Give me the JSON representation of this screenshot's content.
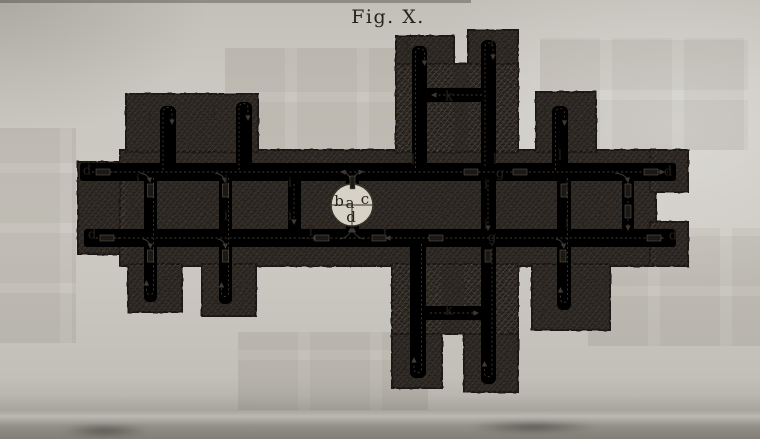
{
  "figure": {
    "title": "Fig. X."
  },
  "colors": {
    "paper": "#cac7c0",
    "mass": "#2a2521",
    "channel": "#d6d2c6",
    "ink": "#26221c",
    "flow": "#3f3a33"
  },
  "labels": [
    {
      "t": "b",
      "x": 339,
      "y": 202,
      "s": 1
    },
    {
      "t": "a",
      "x": 350,
      "y": 204,
      "s": 1
    },
    {
      "t": "c",
      "x": 365,
      "y": 200,
      "s": 1
    },
    {
      "t": "d",
      "x": 351,
      "y": 218,
      "s": 1
    },
    {
      "t": "d",
      "x": 87,
      "y": 171
    },
    {
      "t": "d",
      "x": 92,
      "y": 235
    },
    {
      "t": "d",
      "x": 668,
      "y": 172
    },
    {
      "t": "d",
      "x": 673,
      "y": 236
    },
    {
      "t": "f",
      "x": 311,
      "y": 232
    },
    {
      "t": "f",
      "x": 385,
      "y": 233
    },
    {
      "t": "g",
      "x": 500,
      "y": 174
    },
    {
      "t": "g",
      "x": 492,
      "y": 238
    },
    {
      "t": "i",
      "x": 138,
      "y": 180
    },
    {
      "t": "i",
      "x": 138,
      "y": 216
    },
    {
      "t": "i",
      "x": 226,
      "y": 181
    },
    {
      "t": "i",
      "x": 226,
      "y": 216
    },
    {
      "t": "i",
      "x": 290,
      "y": 183
    },
    {
      "t": "i",
      "x": 290,
      "y": 216
    },
    {
      "t": "i",
      "x": 486,
      "y": 185
    },
    {
      "t": "i",
      "x": 486,
      "y": 225
    },
    {
      "t": "i",
      "x": 567,
      "y": 186
    },
    {
      "t": "i",
      "x": 567,
      "y": 224
    },
    {
      "t": "k",
      "x": 449,
      "y": 97
    },
    {
      "t": "k",
      "x": 449,
      "y": 311
    },
    {
      "t": "l",
      "x": 150,
      "y": 117
    },
    {
      "t": "l",
      "x": 214,
      "y": 112
    },
    {
      "t": "l",
      "x": 407,
      "y": 47
    },
    {
      "t": "l",
      "x": 492,
      "y": 42
    },
    {
      "t": "l",
      "x": 413,
      "y": 160
    },
    {
      "t": "l",
      "x": 495,
      "y": 160
    },
    {
      "t": "l",
      "x": 560,
      "y": 156
    },
    {
      "t": "l",
      "x": 545,
      "y": 113
    },
    {
      "t": "l",
      "x": 160,
      "y": 291
    },
    {
      "t": "l",
      "x": 234,
      "y": 294
    },
    {
      "t": "l",
      "x": 406,
      "y": 367
    },
    {
      "t": "l",
      "x": 498,
      "y": 376
    },
    {
      "t": "l",
      "x": 554,
      "y": 297
    }
  ]
}
